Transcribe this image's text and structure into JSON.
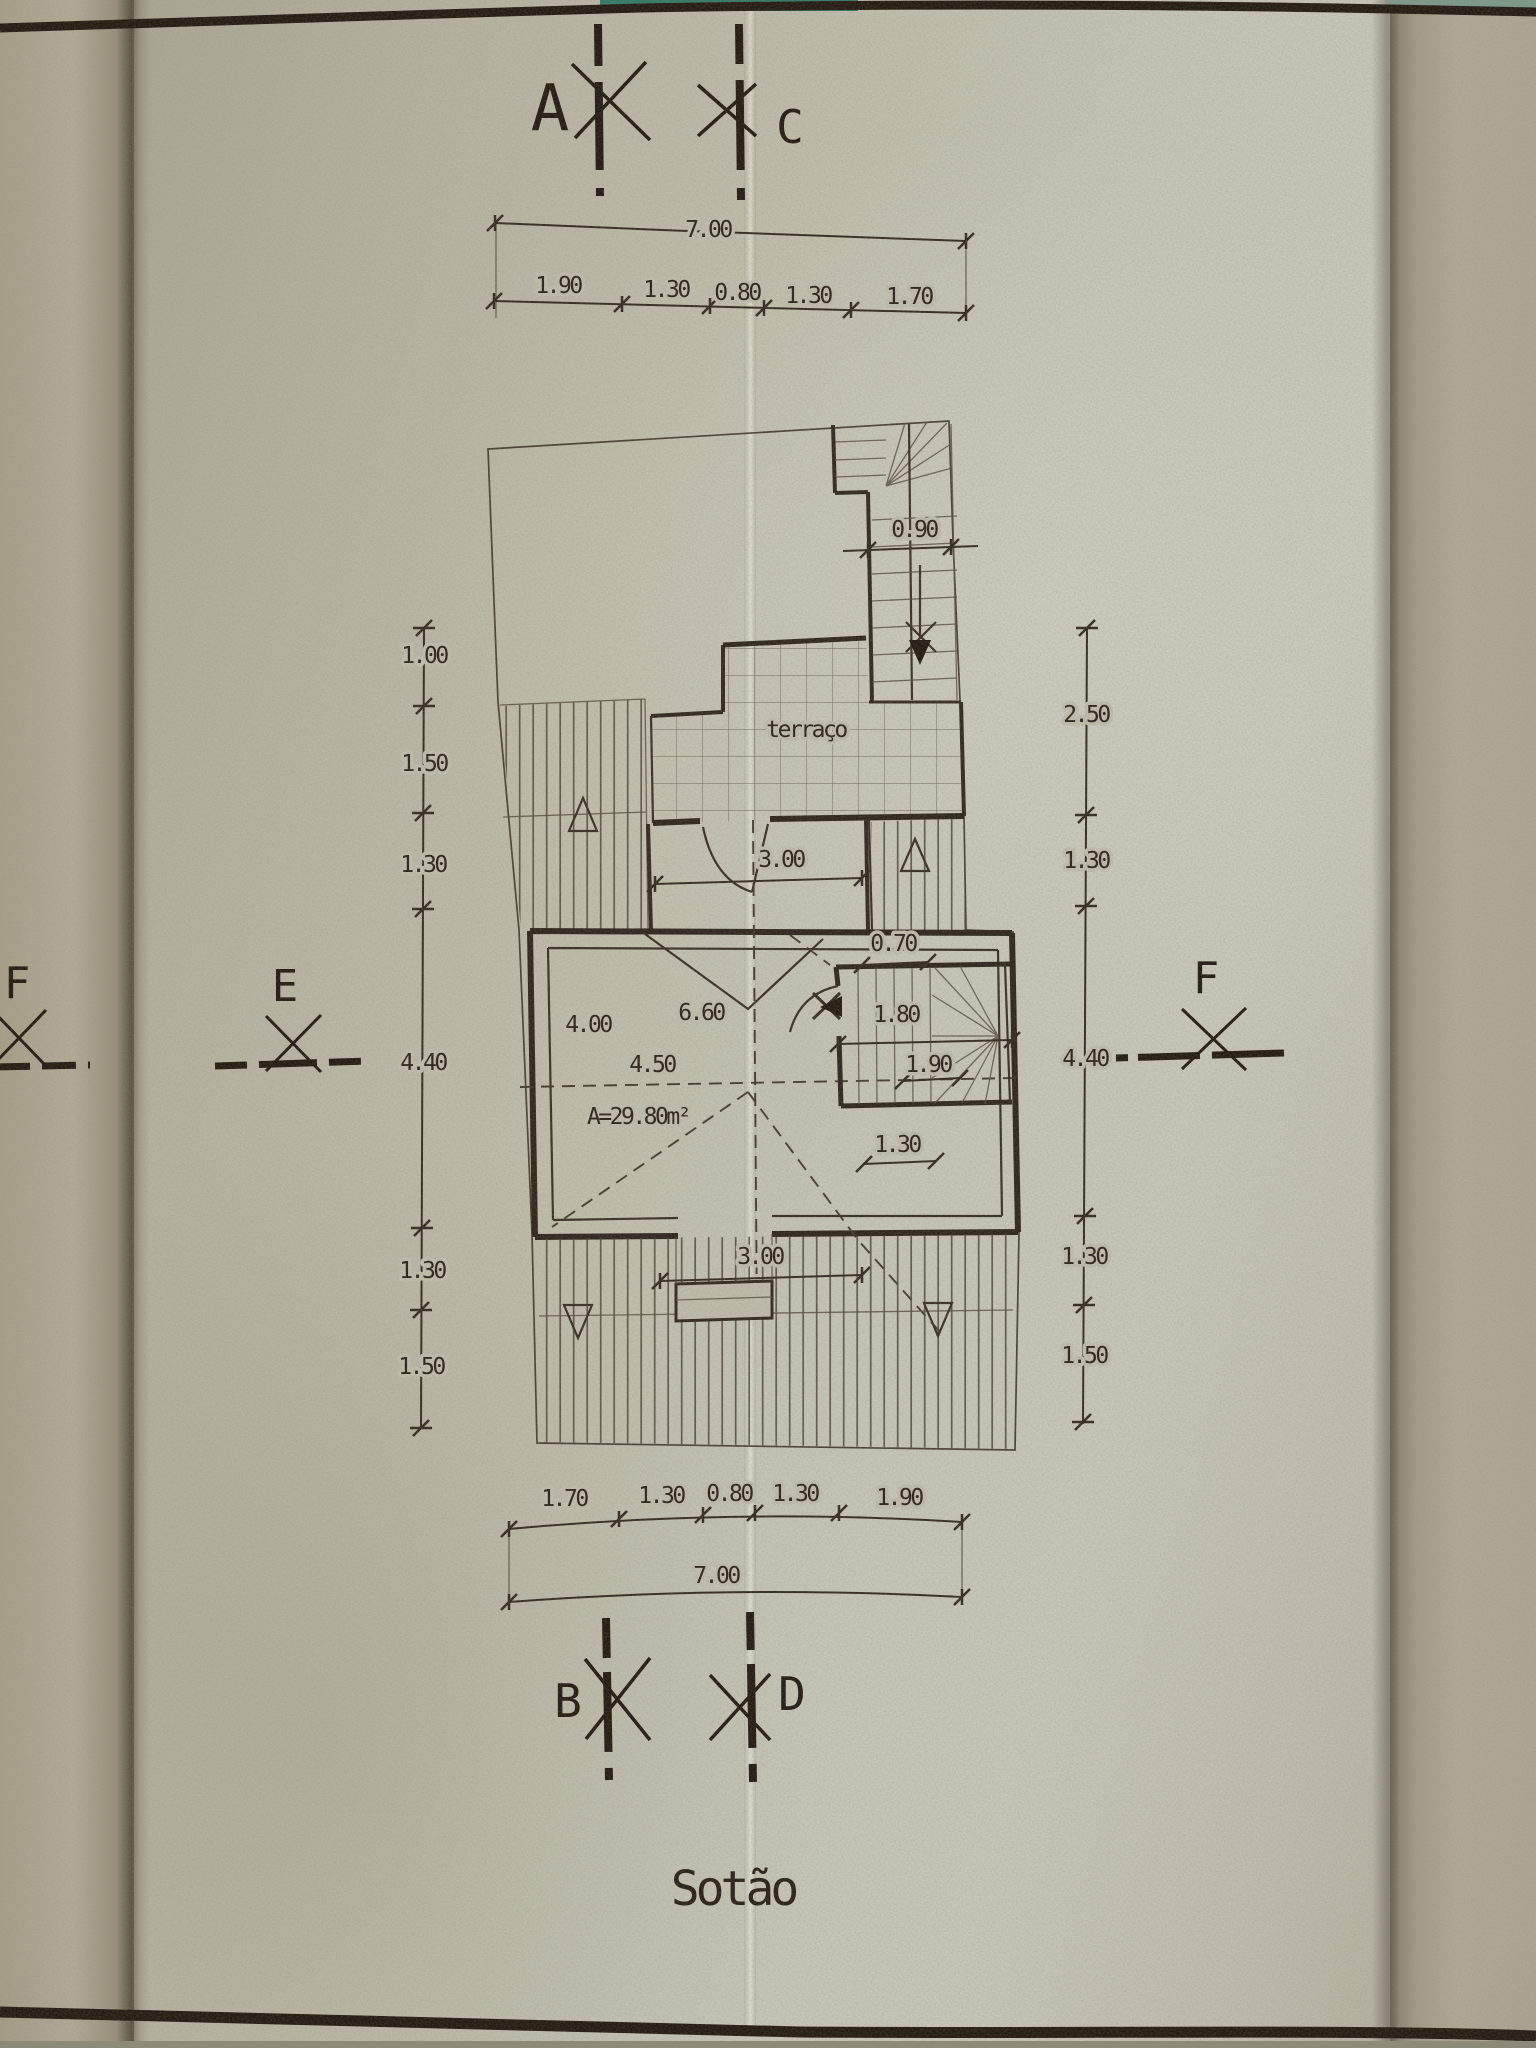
{
  "title": "Sotão",
  "markers": {
    "a": "A",
    "c": "C",
    "b": "B",
    "d": "D",
    "e": "E",
    "f_left": "F",
    "f_right": "F"
  },
  "dims": {
    "top_total": "7.00",
    "top_segments": [
      "1.90",
      "1.30",
      "0.80",
      "1.30",
      "1.70"
    ],
    "bottom_segments": [
      "1.70",
      "1.30",
      "0.80",
      "1.30",
      "1.90"
    ],
    "bottom_total": "7.00",
    "left_chain": [
      "1.00",
      "1.50",
      "1.30",
      "4.40",
      "1.30",
      "1.50"
    ],
    "right_chain": [
      "2.50",
      "1.30",
      "4.40",
      "1.30",
      "1.50"
    ]
  },
  "plan": {
    "terrace_label": "terraço",
    "stair_width": "0.90",
    "upper_door_width": "3.00",
    "landing_depth": "0.70",
    "room_width": "4.00",
    "room_diag_span": "6.60",
    "stairwell_height": "1.80",
    "room_length": "4.50",
    "stair_length": "1.90",
    "room_area": "A=29.80m²",
    "stair_offset": "1.30",
    "lower_door_width": "3.00"
  }
}
